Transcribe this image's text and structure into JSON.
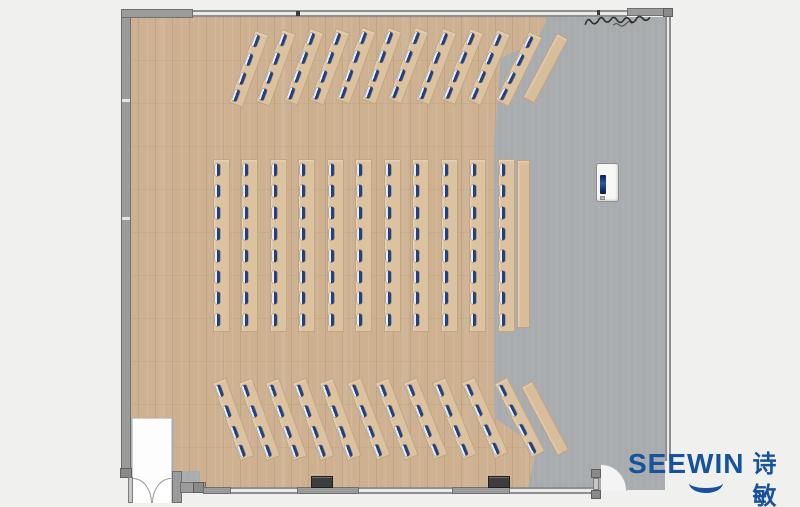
{
  "brand": {
    "name": "SEEWIN",
    "name_cn": "诗敏",
    "color": "#17529f"
  },
  "scene": {
    "type": "furniture-floor-plan",
    "floor_colors": {
      "wood": "#cdb191",
      "stage_gray": "#a8acae"
    },
    "seat_marker_color": "#25417d",
    "furniture_counts": {
      "top_fan_desks": 11,
      "middle_desk_columns": 11,
      "bottom_fan_desks": 11,
      "side_tables": 3,
      "seats_per_fan_desk": 4,
      "seats_per_middle_column": 8,
      "total_seat_markers": 176,
      "podium": 1,
      "double_doors": 1,
      "single_doors": 1
    },
    "annotation": "illegible handwritten scribble, top-right on gray floor"
  },
  "layout": {
    "middle": {
      "x": [
        213,
        241,
        270,
        298,
        327,
        355,
        384,
        412,
        441,
        469,
        498
      ],
      "y": 159,
      "w": 17,
      "h": 173,
      "rows": 8,
      "seat_y0": 4,
      "seat_dy": 21.4,
      "plain": {
        "x": 517,
        "y": 160,
        "w": 13,
        "h": 168,
        "angle": 0
      }
    },
    "top_fan": {
      "x": [
        255,
        282,
        310,
        336,
        362,
        388,
        415,
        443,
        470,
        497,
        529
      ],
      "y": [
        30,
        29,
        28,
        28,
        27,
        27,
        27,
        28,
        28,
        29,
        31
      ],
      "angles": [
        20,
        20,
        20,
        20,
        20,
        20,
        21,
        21,
        22,
        23,
        26
      ],
      "w": 15,
      "h": 77,
      "seats": [
        3,
        23,
        43,
        61
      ],
      "plain": {
        "x": 557,
        "y": 33,
        "w": 13,
        "h": 73,
        "angle": 28
      }
    },
    "bottom_fan": {
      "x": [
        212,
        238,
        265,
        292,
        319,
        347,
        375,
        403,
        432,
        461,
        494
      ],
      "y": [
        383,
        383,
        383,
        383,
        383,
        383,
        383,
        383,
        383,
        383,
        384
      ],
      "angles": [
        -20,
        -20,
        -20,
        -20,
        -20,
        -21,
        -21,
        -22,
        -22,
        -24,
        -27
      ],
      "w": 15,
      "h": 83,
      "seats": [
        3,
        25,
        47,
        67
      ],
      "plain": {
        "x": 521,
        "y": 387,
        "w": 13,
        "h": 78,
        "angle": -28
      }
    }
  }
}
